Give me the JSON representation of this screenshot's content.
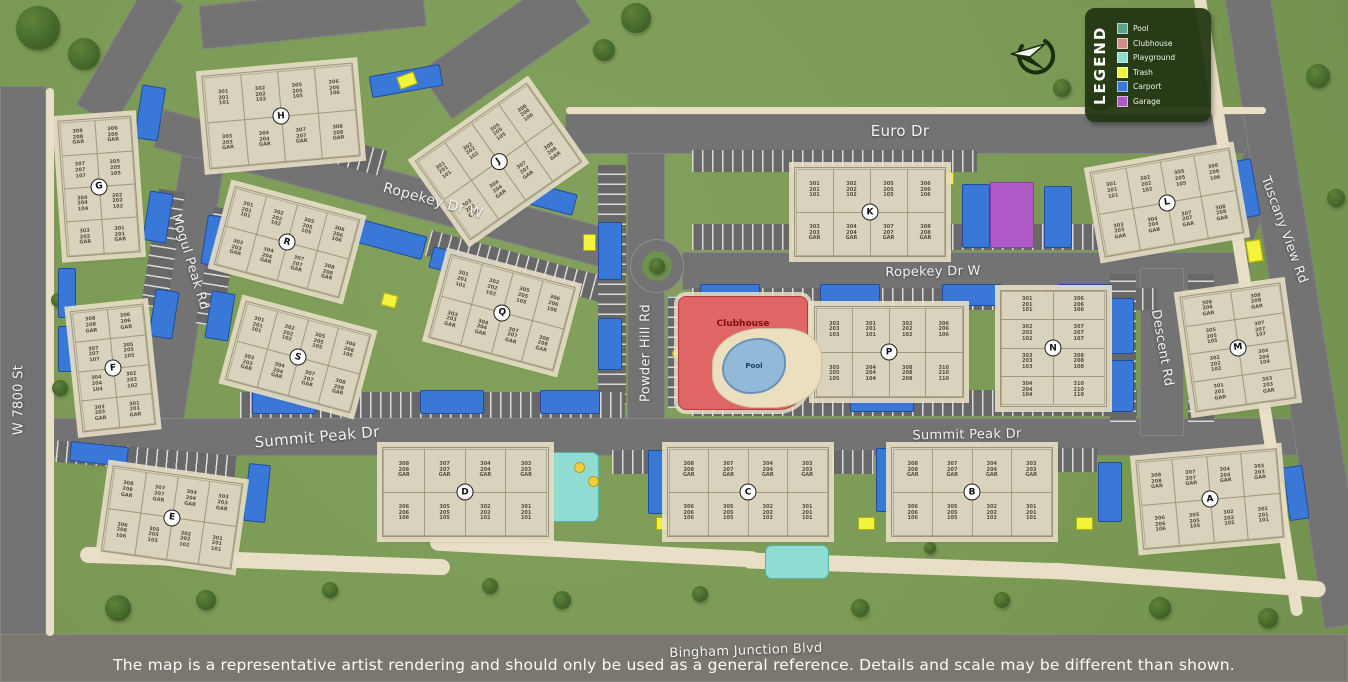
{
  "map": {
    "disclaimer": "The map is a representative artist rendering and should only be used as a general reference. Details and scale may be different than shown.",
    "legend": {
      "title": "LEGEND",
      "items": [
        {
          "label": "Pool",
          "color": "#5aa38d"
        },
        {
          "label": "Clubhouse",
          "color": "#d18d8d"
        },
        {
          "label": "Playground",
          "color": "#8fdcd2"
        },
        {
          "label": "Trash",
          "color": "#f2f43c"
        },
        {
          "label": "Carport",
          "color": "#3a78d8"
        },
        {
          "label": "Garage",
          "color": "#ad5ac6"
        }
      ]
    },
    "amenities": {
      "clubhouse": "Clubhouse",
      "pool": "Pool"
    },
    "streets": [
      {
        "name": "Euro Dr",
        "x": 900,
        "y": 131,
        "rot": 0,
        "size": 15
      },
      {
        "name": "Ropekey Dr W",
        "x": 433,
        "y": 201,
        "rot": 15,
        "size": 14
      },
      {
        "name": "Ropekey Dr W",
        "x": 933,
        "y": 272,
        "rot": -1,
        "size": 13
      },
      {
        "name": "Summit Peak Dr",
        "x": 317,
        "y": 437,
        "rot": -5,
        "size": 15
      },
      {
        "name": "Summit Peak Dr",
        "x": 967,
        "y": 435,
        "rot": -1,
        "size": 13
      },
      {
        "name": "Powder Hill Rd",
        "x": 646,
        "y": 353,
        "rot": -90,
        "size": 13
      },
      {
        "name": "Mogul Peak Rd",
        "x": 190,
        "y": 262,
        "rot": 73,
        "size": 13
      },
      {
        "name": "Descent Rd",
        "x": 1162,
        "y": 348,
        "rot": 80,
        "size": 13
      },
      {
        "name": "Tuscany View Rd",
        "x": 1284,
        "y": 230,
        "rot": 70,
        "size": 13
      },
      {
        "name": "W 7800 St",
        "x": 19,
        "y": 400,
        "rot": -90,
        "size": 13
      },
      {
        "name": "Bingham Junction Blvd",
        "x": 746,
        "y": 651,
        "rot": -2,
        "size": 13
      }
    ],
    "buildings": [
      {
        "letter": "A",
        "x": 1209,
        "y": 498,
        "w": 140,
        "h": 88,
        "rot": -5,
        "cols": 4,
        "stacks": [
          "308|208|GAR",
          "307|207|GAR",
          "304|204|GAR",
          "303|203|GAR",
          "306|206|106",
          "305|205|105",
          "302|202|102",
          "301|201|101"
        ]
      },
      {
        "letter": "B",
        "x": 971,
        "y": 491,
        "w": 160,
        "h": 88,
        "rot": 0,
        "cols": 4,
        "stacks": [
          "308|208|GAR",
          "307|207|GAR",
          "304|204|GAR",
          "303|203|GAR",
          "306|206|106",
          "305|205|105",
          "302|202|102",
          "301|201|101"
        ]
      },
      {
        "letter": "C",
        "x": 747,
        "y": 491,
        "w": 160,
        "h": 88,
        "rot": 0,
        "cols": 4,
        "stacks": [
          "308|208|GAR",
          "307|207|GAR",
          "304|204|GAR",
          "303|203|GAR",
          "306|206|106",
          "305|205|105",
          "302|202|102",
          "301|201|101"
        ]
      },
      {
        "letter": "D",
        "x": 464,
        "y": 491,
        "w": 165,
        "h": 88,
        "rot": 0,
        "cols": 4,
        "stacks": [
          "308|208|GAR",
          "307|207|GAR",
          "304|204|GAR",
          "303|203|GAR",
          "306|206|106",
          "305|205|105",
          "302|202|102",
          "301|201|101"
        ]
      },
      {
        "letter": "E",
        "x": 171,
        "y": 516,
        "w": 130,
        "h": 85,
        "rot": 8,
        "cols": 4,
        "stacks": [
          "308|208|GAR",
          "307|207|GAR",
          "304|204|GAR",
          "303|203|GAR",
          "306|206|106",
          "305|205|105",
          "302|202|102",
          "301|201|101"
        ]
      },
      {
        "letter": "F",
        "x": 112,
        "y": 367,
        "w": 72,
        "h": 120,
        "rot": -6,
        "cols": 2,
        "stacks": [
          "308|208|GAR",
          "306|206|GAR",
          "307|207|107",
          "305|205|105",
          "304|204|104",
          "302|202|102",
          "303|203|GAR",
          "301|201|GAR"
        ]
      },
      {
        "letter": "G",
        "x": 98,
        "y": 185,
        "w": 72,
        "h": 135,
        "rot": -4,
        "cols": 2,
        "stacks": [
          "308|208|GAR",
          "306|206|GAR",
          "307|207|107",
          "305|205|105",
          "304|204|104",
          "302|202|102",
          "303|203|GAR",
          "301|201|GAR"
        ]
      },
      {
        "letter": "H",
        "x": 280,
        "y": 115,
        "w": 150,
        "h": 92,
        "rot": -5,
        "cols": 4,
        "stacks": [
          "301|201|101",
          "302|202|102",
          "305|205|105",
          "306|206|106",
          "303|203|GAR",
          "304|204|GAR",
          "307|207|GAR",
          "308|208|GAR"
        ]
      },
      {
        "letter": "J",
        "x": 497,
        "y": 160,
        "w": 135,
        "h": 95,
        "rot": -35,
        "cols": 4,
        "stacks": [
          "301|201|101",
          "302|202|102",
          "305|205|105",
          "306|206|106",
          "303|203|GAR",
          "304|204|GAR",
          "307|207|GAR",
          "308|208|GAR"
        ]
      },
      {
        "letter": "K",
        "x": 869,
        "y": 211,
        "w": 150,
        "h": 88,
        "rot": 0,
        "cols": 4,
        "stacks": [
          "301|201|101",
          "302|202|102",
          "305|205|105",
          "306|206|106",
          "303|203|GAR",
          "304|204|GAR",
          "307|207|GAR",
          "308|208|GAR"
        ]
      },
      {
        "letter": "L",
        "x": 1166,
        "y": 201,
        "w": 140,
        "h": 85,
        "rot": -10,
        "cols": 4,
        "stacks": [
          "301|201|101",
          "302|202|102",
          "305|205|105",
          "306|206|106",
          "303|203|GAR",
          "304|204|GAR",
          "307|207|GAR",
          "308|208|GAR"
        ]
      },
      {
        "letter": "M",
        "x": 1237,
        "y": 346,
        "w": 100,
        "h": 115,
        "rot": -8,
        "cols": 2,
        "stacks": [
          "306|206|GAR",
          "308|208|GAR",
          "305|205|105",
          "307|207|107",
          "302|202|102",
          "304|204|104",
          "301|201|GAR",
          "303|203|GAR"
        ]
      },
      {
        "letter": "N",
        "x": 1052,
        "y": 347,
        "w": 105,
        "h": 115,
        "rot": 0,
        "cols": 2,
        "stacks": [
          "301|201|101",
          "306|206|106",
          "302|202|102",
          "307|207|107",
          "303|203|103",
          "308|208|108",
          "304|204|104",
          "310|210|110"
        ]
      },
      {
        "letter": "P",
        "x": 888,
        "y": 351,
        "w": 148,
        "h": 90,
        "rot": 0,
        "cols": 4,
        "stacks": [
          "303|203|103",
          "301|201|101",
          "302|202|102",
          "306|206|106",
          "305|205|105",
          "304|204|104",
          "308|208|208",
          "310|210|110"
        ]
      },
      {
        "letter": "Q",
        "x": 501,
        "y": 311,
        "w": 128,
        "h": 85,
        "rot": 15,
        "cols": 4,
        "stacks": [
          "301|201|101",
          "302|202|102",
          "305|205|105",
          "306|206|106",
          "303|203|GAR",
          "304|204|GAR",
          "307|207|GAR",
          "308|208|GAR"
        ]
      },
      {
        "letter": "R",
        "x": 286,
        "y": 241,
        "w": 128,
        "h": 80,
        "rot": 15,
        "cols": 4,
        "stacks": [
          "301|201|101",
          "302|202|102",
          "305|205|105",
          "306|206|106",
          "303|203|GAR",
          "304|204|GAR",
          "307|207|GAR",
          "308|208|GAR"
        ]
      },
      {
        "letter": "S",
        "x": 297,
        "y": 356,
        "w": 128,
        "h": 80,
        "rot": 15,
        "cols": 4,
        "stacks": [
          "301|201|101",
          "302|202|102",
          "305|205|105",
          "306|206|106",
          "303|203|GAR",
          "304|204|GAR",
          "307|207|GAR",
          "308|208|GAR"
        ]
      }
    ],
    "features": {
      "carports": [
        [
          370,
          70,
          70,
          20,
          -10
        ],
        [
          338,
          225,
          86,
          22,
          15
        ],
        [
          512,
          186,
          62,
          20,
          15
        ],
        [
          430,
          254,
          62,
          20,
          15
        ],
        [
          138,
          86,
          22,
          52,
          9
        ],
        [
          146,
          192,
          22,
          48,
          9
        ],
        [
          204,
          216,
          22,
          48,
          9
        ],
        [
          152,
          290,
          22,
          46,
          9
        ],
        [
          208,
          292,
          22,
          46,
          9
        ],
        [
          58,
          268,
          16,
          48,
          0
        ],
        [
          58,
          326,
          16,
          44,
          0
        ],
        [
          598,
          222,
          22,
          56,
          0
        ],
        [
          598,
          318,
          22,
          50,
          0
        ],
        [
          962,
          184,
          26,
          62,
          0
        ],
        [
          1044,
          186,
          26,
          60,
          0
        ],
        [
          1230,
          160,
          24,
          56,
          -10
        ],
        [
          700,
          284,
          58,
          20,
          0
        ],
        [
          820,
          284,
          58,
          20,
          0
        ],
        [
          942,
          284,
          58,
          20,
          0
        ],
        [
          1058,
          284,
          52,
          20,
          0
        ],
        [
          1108,
          298,
          24,
          54,
          0
        ],
        [
          1108,
          360,
          24,
          50,
          0
        ],
        [
          1190,
          294,
          24,
          52,
          0
        ],
        [
          1190,
          354,
          24,
          54,
          0
        ],
        [
          252,
          390,
          62,
          22,
          0
        ],
        [
          420,
          390,
          62,
          22,
          0
        ],
        [
          540,
          390,
          58,
          22,
          0
        ],
        [
          724,
          388,
          62,
          22,
          0
        ],
        [
          850,
          388,
          62,
          22,
          0
        ],
        [
          1002,
          386,
          62,
          22,
          0
        ],
        [
          70,
          444,
          56,
          18,
          6
        ],
        [
          246,
          464,
          20,
          56,
          6
        ],
        [
          648,
          450,
          22,
          62,
          0
        ],
        [
          876,
          448,
          22,
          62,
          0
        ],
        [
          1098,
          462,
          22,
          58,
          0
        ],
        [
          1286,
          466,
          18,
          52,
          -8
        ]
      ],
      "trash": [
        [
          398,
          74,
          16,
          11,
          -20
        ],
        [
          583,
          234,
          11,
          15,
          0
        ],
        [
          936,
          172,
          16,
          11,
          0
        ],
        [
          1247,
          240,
          13,
          20,
          -9
        ],
        [
          382,
          294,
          13,
          11,
          15
        ],
        [
          77,
          387,
          15,
          11,
          0
        ],
        [
          656,
          517,
          15,
          11,
          0
        ],
        [
          858,
          517,
          15,
          11,
          0
        ],
        [
          1076,
          517,
          15,
          11,
          0
        ]
      ],
      "garages": [
        [
          990,
          182,
          42,
          64
        ]
      ],
      "playgrounds": [
        [
          542,
          452,
          55,
          68
        ],
        [
          765,
          545,
          62,
          32
        ]
      ],
      "umbrellas": [
        [
          676,
          352
        ],
        [
          688,
          380
        ],
        [
          762,
          350
        ],
        [
          754,
          382
        ],
        [
          796,
          362
        ],
        [
          578,
          466
        ],
        [
          592,
          480
        ]
      ],
      "trees": [
        [
          38,
          28,
          44
        ],
        [
          84,
          54,
          32
        ],
        [
          636,
          18,
          30
        ],
        [
          604,
          50,
          22
        ],
        [
          1100,
          98,
          26
        ],
        [
          1062,
          88,
          18
        ],
        [
          118,
          608,
          26
        ],
        [
          206,
          600,
          20
        ],
        [
          330,
          590,
          16
        ],
        [
          490,
          586,
          16
        ],
        [
          562,
          600,
          18
        ],
        [
          700,
          594,
          16
        ],
        [
          860,
          608,
          18
        ],
        [
          1002,
          600,
          16
        ],
        [
          1160,
          608,
          22
        ],
        [
          1268,
          618,
          20
        ],
        [
          60,
          388,
          16
        ],
        [
          58,
          300,
          14
        ],
        [
          1318,
          76,
          24
        ],
        [
          1336,
          198,
          18
        ],
        [
          930,
          548,
          12
        ],
        [
          1290,
          478,
          18
        ],
        [
          657,
          266,
          16
        ]
      ]
    }
  }
}
